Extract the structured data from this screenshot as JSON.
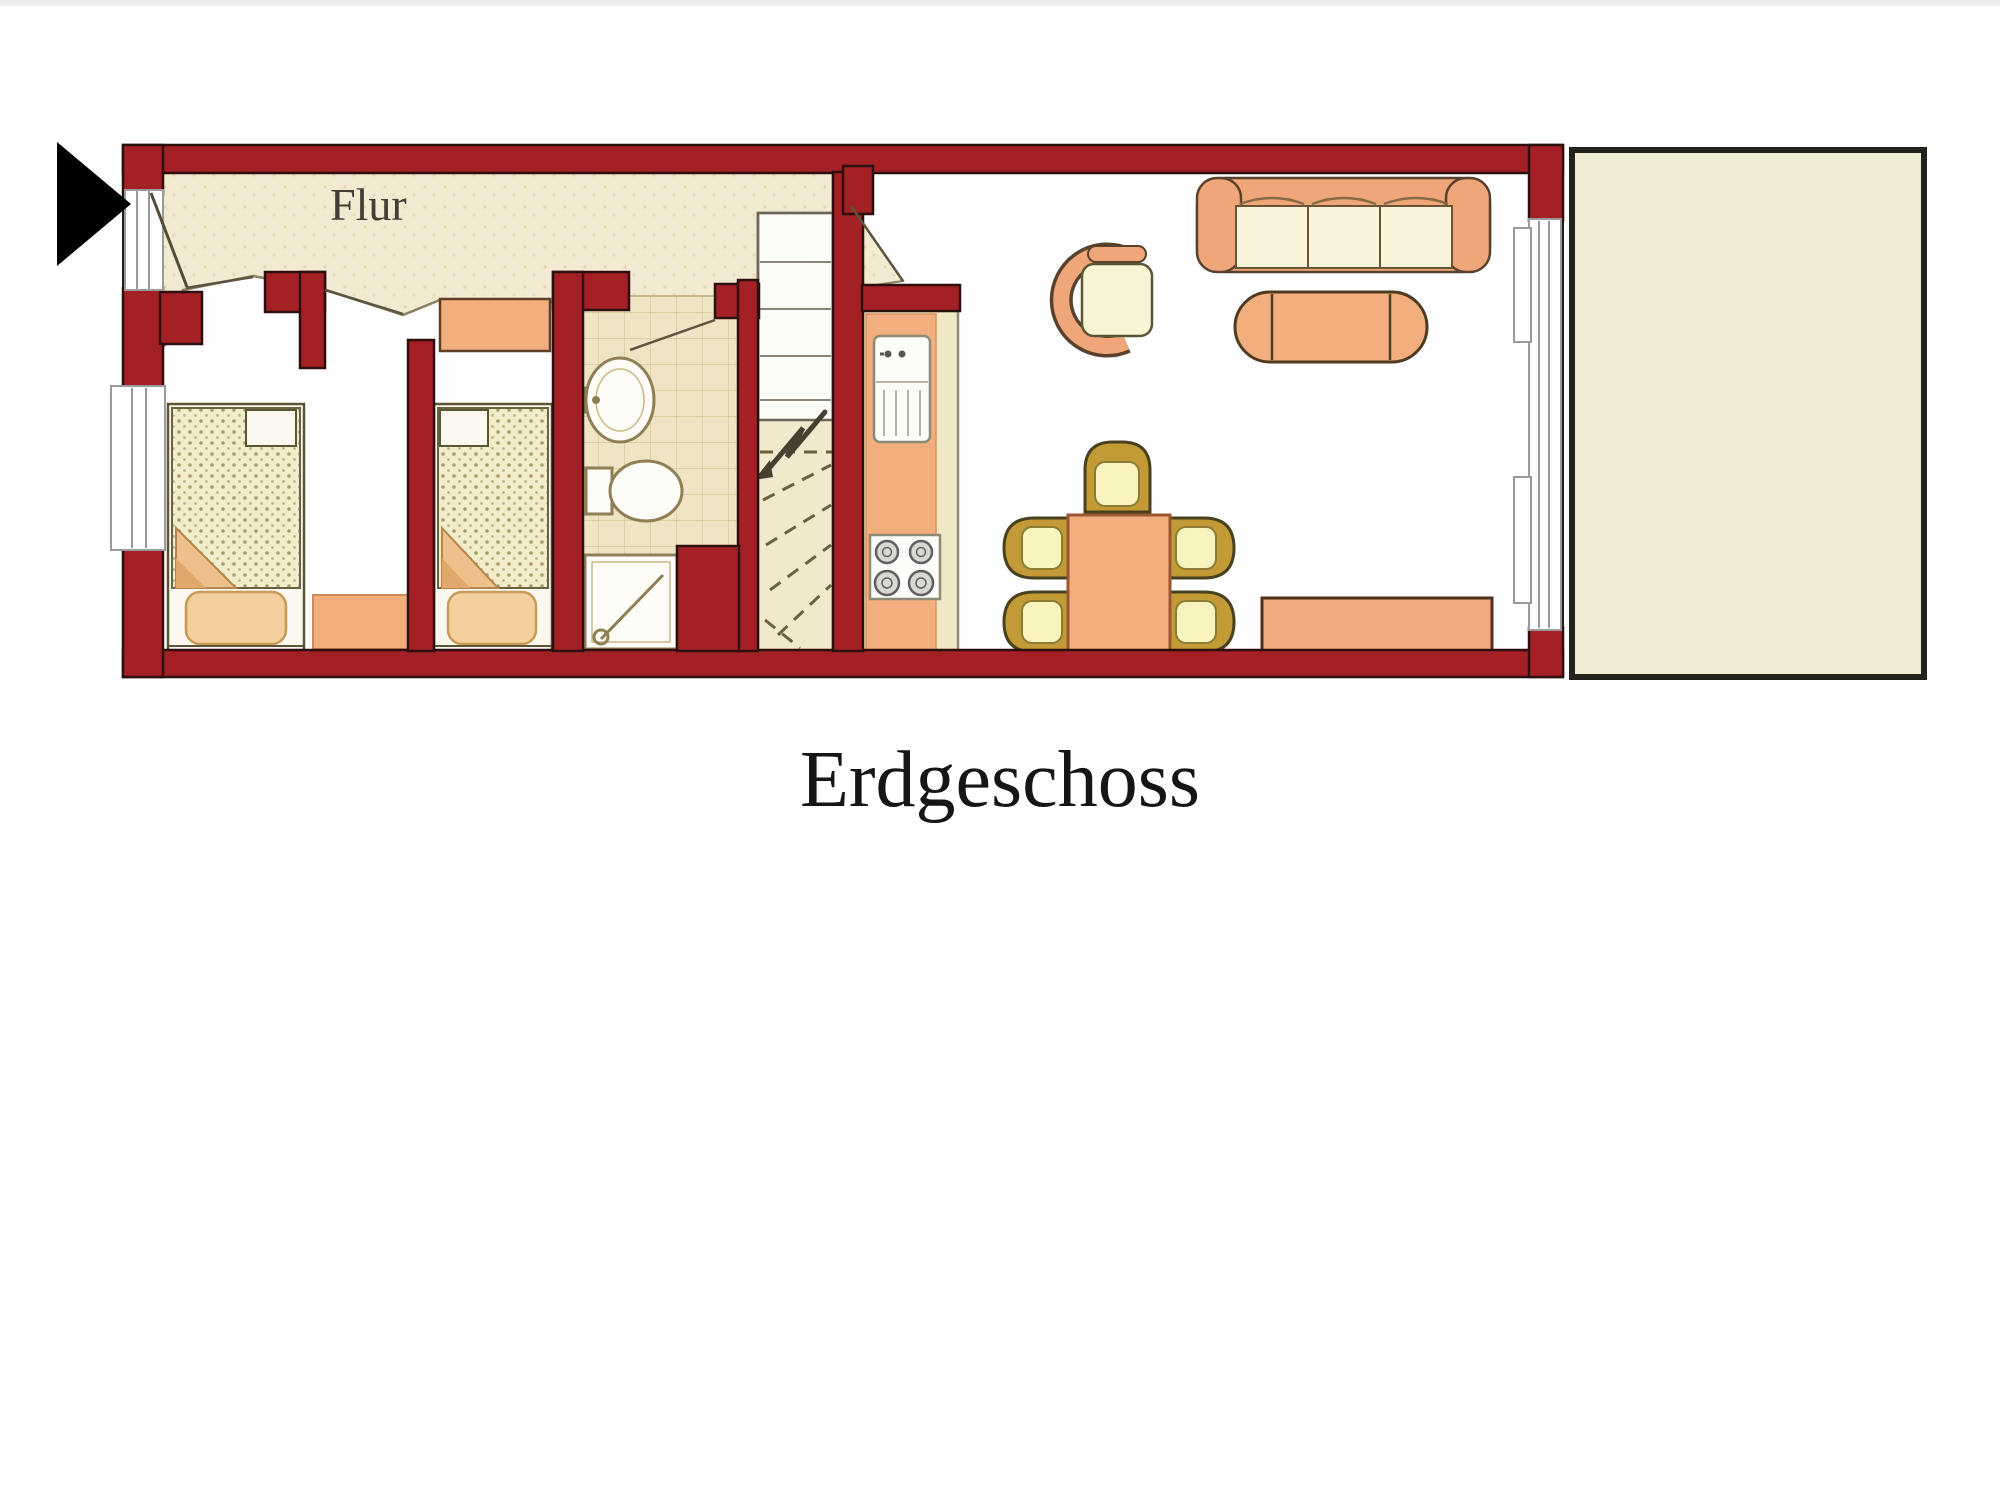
{
  "page": {
    "background": "#ffffff"
  },
  "floorplan": {
    "title": "Erdgeschoss",
    "hallway_label": "Flur",
    "colors": {
      "wall-red": "#a32025",
      "wall-outline": "#2e0f0f",
      "floor-cream": "#f2ebd1",
      "tile-cream": "#efe5c4",
      "tile-line": "#d9c79b",
      "furniture-orange": "#f2ae7d",
      "sofa-salmon": "#efa679",
      "cushion-cream": "#f8f4dc",
      "chair-gold": "#c29a36",
      "chair-cushion": "#f9f3bd",
      "bed-blanket": "#f1ecca",
      "pillow-peach": "#f4cf9e",
      "outline-dark": "#4a421f",
      "terrace-fill": "#f1edd2",
      "terrace-border": "#23231c",
      "window-gray": "#9a9a9a",
      "arrow-black": "#000000"
    },
    "areas": [
      "entrance",
      "hallway",
      "bedroom-left",
      "bedroom-middle",
      "bathroom",
      "staircase",
      "kitchen",
      "living-dining-room",
      "terrace"
    ],
    "furniture_icons": [
      "single-bed-icon",
      "dresser-icon",
      "washbasin-icon",
      "toilet-icon",
      "shower-icon",
      "kitchen-sink-icon",
      "stove-icon",
      "sofa-icon",
      "armchair-icon",
      "coffee-table-icon",
      "dining-table-icon",
      "dining-chair-icon",
      "sideboard-icon"
    ]
  }
}
